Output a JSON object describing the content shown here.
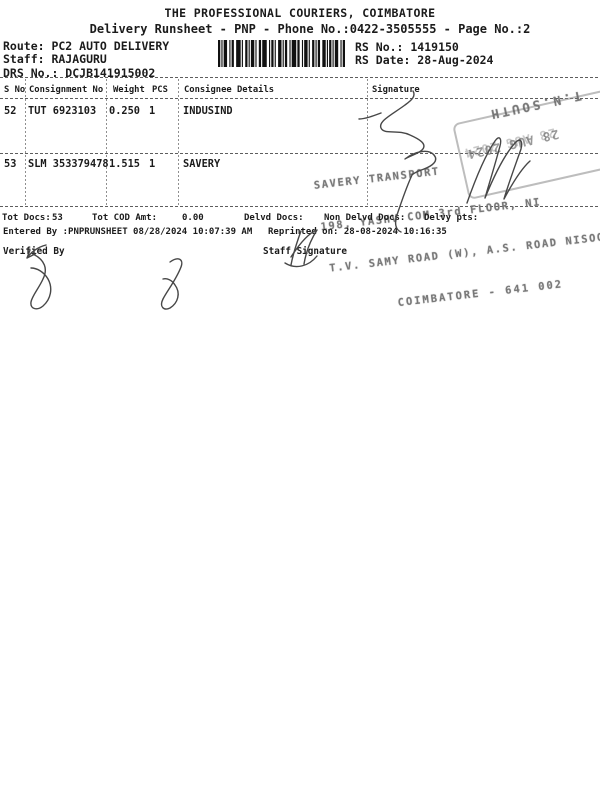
{
  "header": {
    "title": "THE PROFESSIONAL COURIERS, COIMBATORE",
    "subtitle": "Delivery Runsheet - PNP - Phone No.:0422-3505555 - Page No.:2",
    "route": "Route: PC2 AUTO DELIVERY",
    "staff": "Staff: RAJAGURU",
    "drs": "DRS No.: DCJB141915002",
    "rs_no": "RS No.: 1419150",
    "rs_date": "RS Date: 28-Aug-2024"
  },
  "table": {
    "columns": [
      "S No",
      "Consignment No",
      "Weight",
      "PCS",
      "Consignee Details",
      "Signature"
    ],
    "rows": [
      {
        "s_no": "52",
        "consignment_no": "TUT 6923103",
        "weight": "0.250",
        "pcs": "1",
        "consignee": "INDUSIND"
      },
      {
        "s_no": "53",
        "consignment_no": "SLM 353379478",
        "weight": "1.515",
        "pcs": "1",
        "consignee": "SAVERY"
      }
    ]
  },
  "stamp": {
    "region": "T.N.SOUTH",
    "date": "28 AUG 2024",
    "line1": "SAVERY TRANSPORT",
    "line2": "198, YASHV COM 3rd FLOOR, NI",
    "line3": "T.V. SAMY ROAD (W), A.S. ROAD NISOO",
    "line4": "COIMBATORE - 641 002"
  },
  "totals": {
    "tot_docs_label": "Tot Docs:",
    "tot_docs_value": "53",
    "tot_cod_label": "Tot COD Amt:",
    "tot_cod_value": "0.00",
    "delvd_label": "Delvd Docs:",
    "non_delvd_label": "Non Delvd Docs:",
    "delvy_pts_label": "Delvy pts:",
    "entered_by": "Entered By :PNPRUNSHEET 08/28/2024 10:07:39 AM",
    "reprinted_on": "Reprinted on: 28-08-2024 10:16:35"
  },
  "footer": {
    "verified_by": "Verified By",
    "staff_signature": "Staff Signature"
  },
  "colors": {
    "ink": "#1b1b1b",
    "stamp_gray": "#707070",
    "signature_gray": "#474747"
  }
}
